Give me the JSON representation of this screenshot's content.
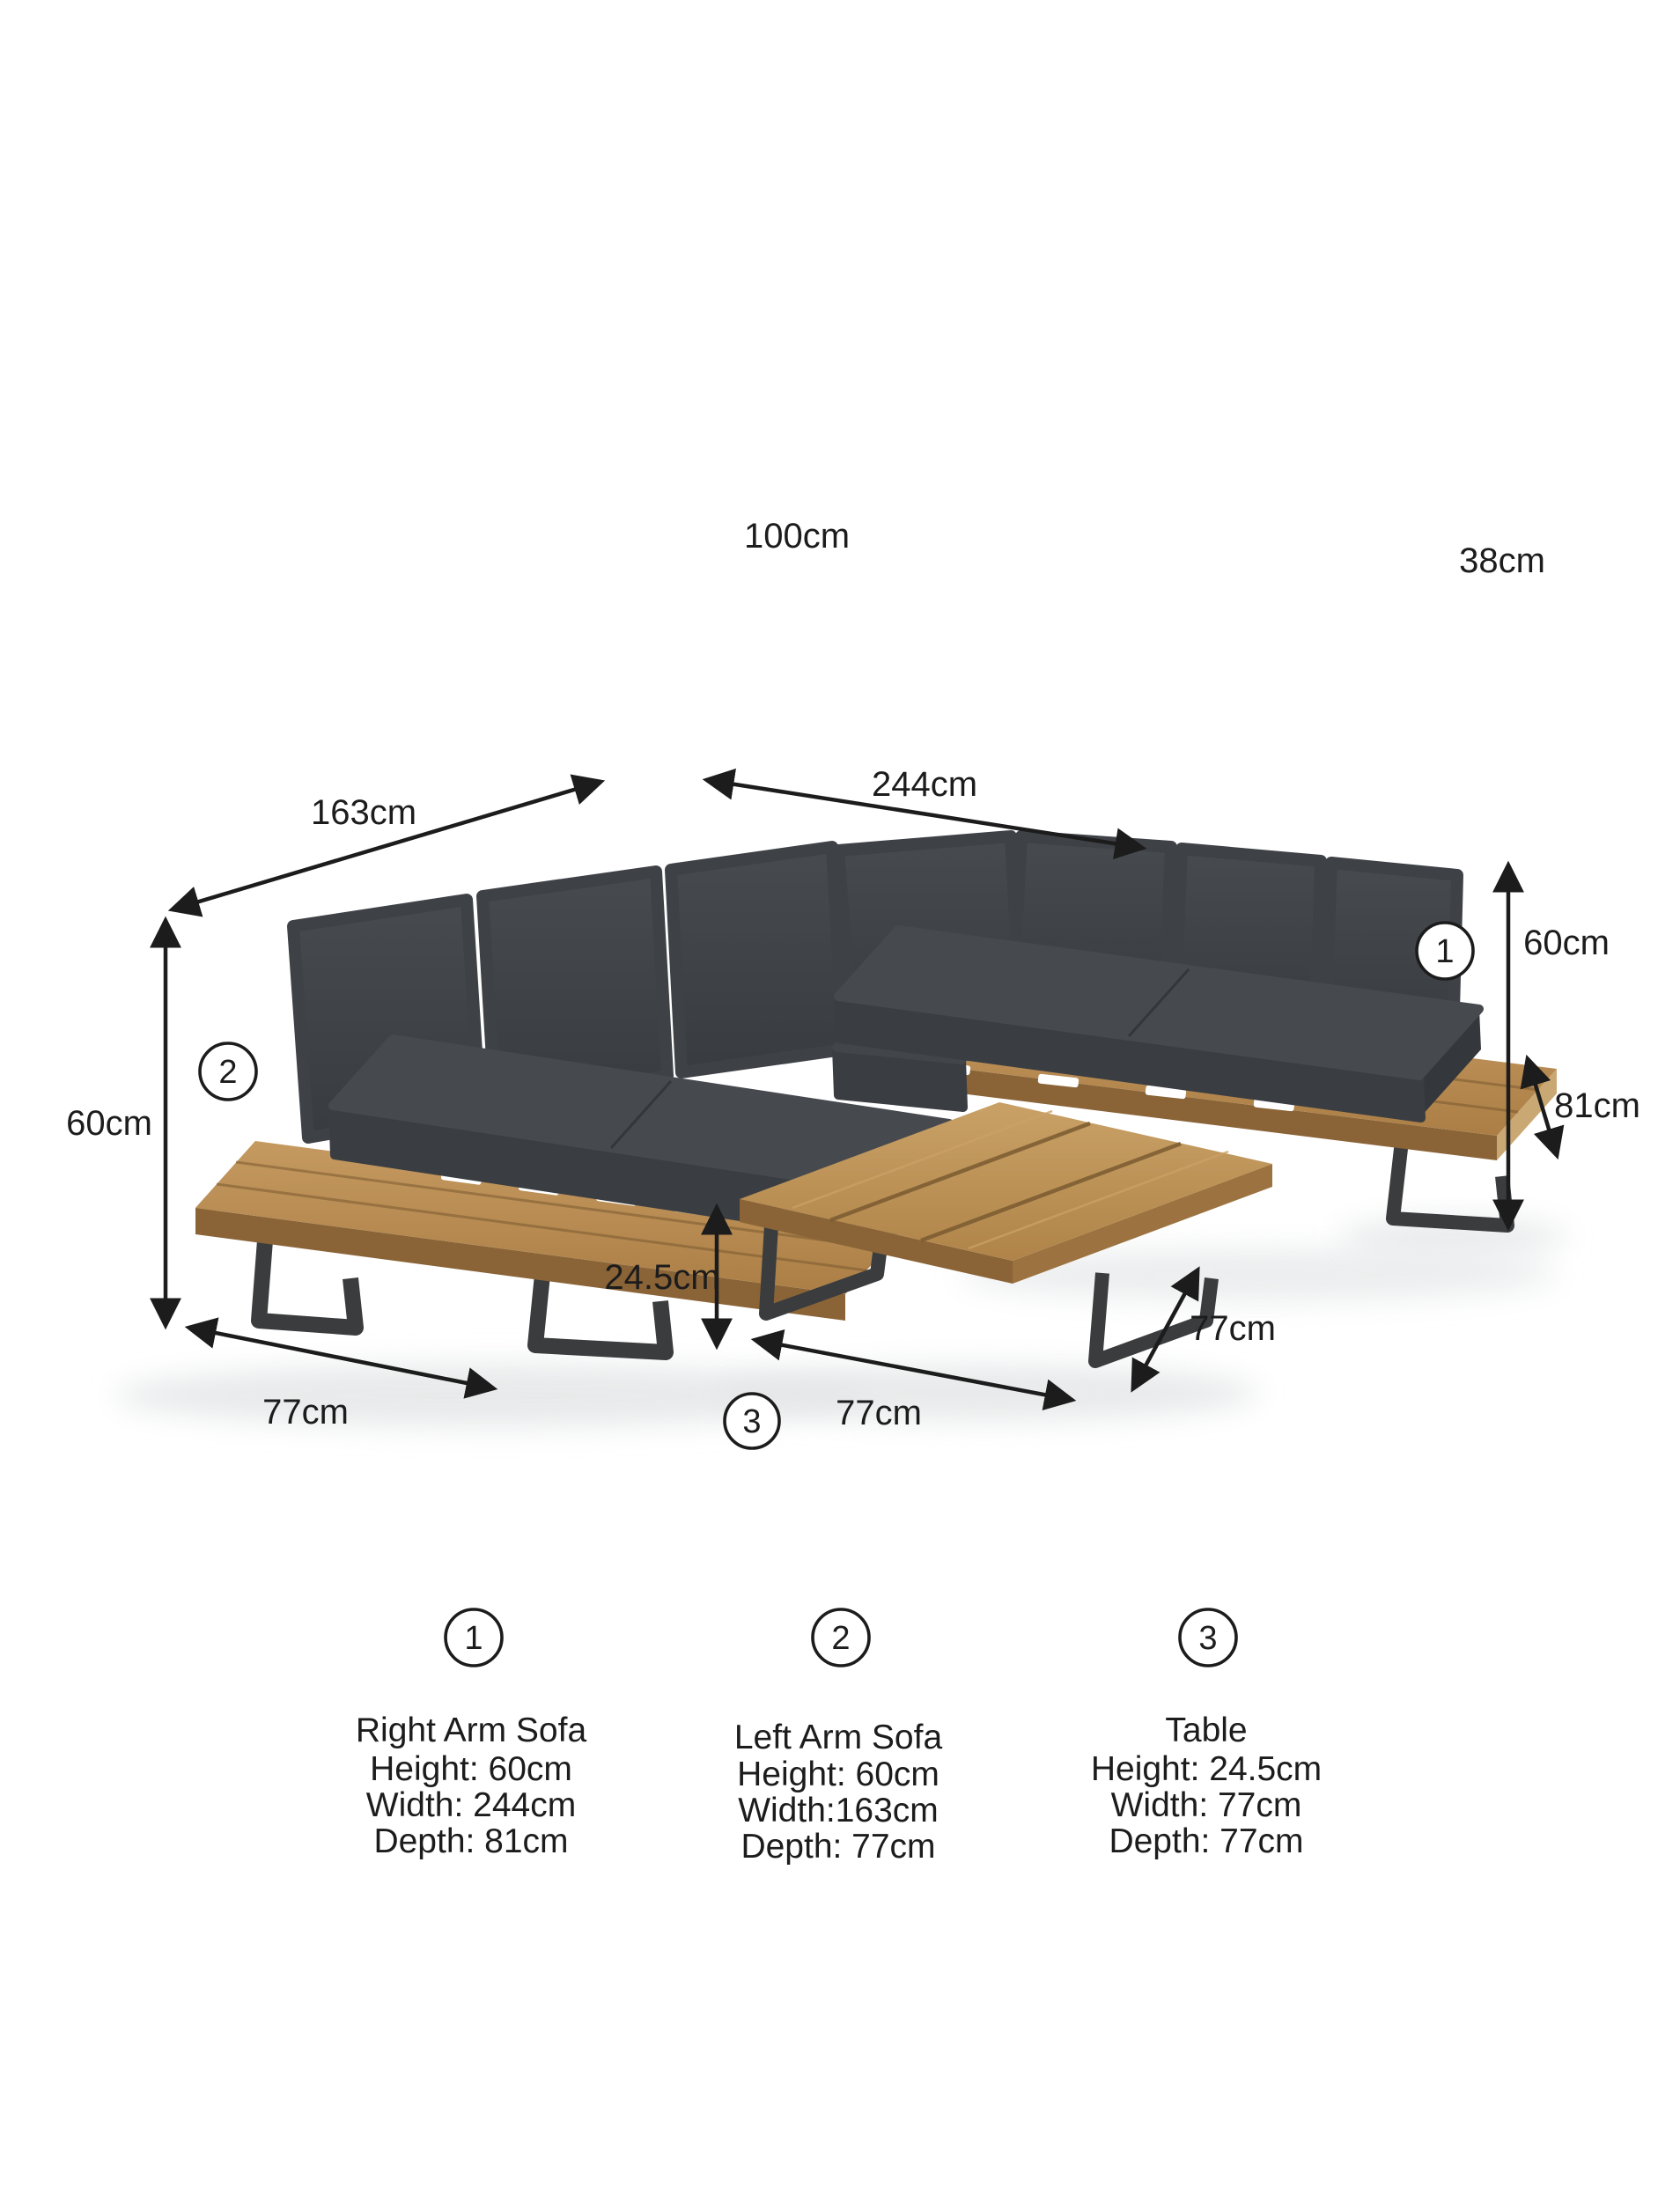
{
  "diagram": {
    "floating_labels": {
      "seat_width": "100cm",
      "back_cushion_height": "38cm"
    },
    "dimensions": {
      "left_sofa_width": "163cm",
      "right_sofa_width": "244cm",
      "right_sofa_height": "60cm",
      "right_sofa_depth": "81cm",
      "left_sofa_height": "60cm",
      "table_height": "24.5cm",
      "table_depth": "77cm",
      "left_sofa_depth": "77cm",
      "table_width": "77cm"
    },
    "markers": {
      "right_sofa": "1",
      "left_sofa": "2",
      "table": "3"
    }
  },
  "legend": {
    "items": [
      {
        "number": "1",
        "name": "Right Arm Sofa",
        "specs": [
          "Height: 60cm",
          "Width: 244cm",
          "Depth: 81cm"
        ]
      },
      {
        "number": "2",
        "name": "Left Arm Sofa",
        "specs": [
          "Height: 60cm",
          "Width:163cm",
          "Depth: 77cm"
        ]
      },
      {
        "number": "3",
        "name": "Table",
        "specs": [
          "Height: 24.5cm",
          "Width: 77cm",
          "Depth: 77cm"
        ]
      }
    ]
  },
  "colors": {
    "background": "#ffffff",
    "annotation_line": "#1c1c1c",
    "wood": "#b98e55",
    "wood_dark_edge": "#8a6437",
    "wood_end_grain": "#c9a873",
    "cushion": "#3e4247",
    "cushion_dark": "#34373b",
    "metal_leg": "#3a3c3e"
  }
}
